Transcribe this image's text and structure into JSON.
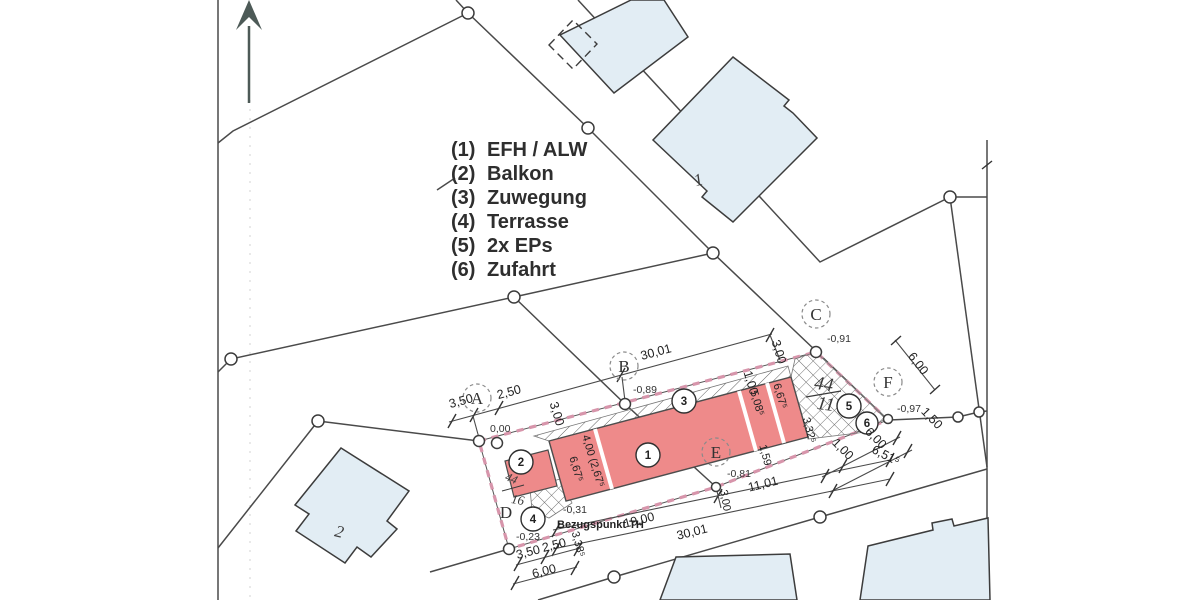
{
  "title": "Lageplan (site plan)",
  "legend": {
    "items": [
      {
        "num": "(1)",
        "label": "EFH / ALW"
      },
      {
        "num": "(2)",
        "label": "Balkon"
      },
      {
        "num": "(3)",
        "label": "Zuwegung"
      },
      {
        "num": "(4)",
        "label": "Terrasse"
      },
      {
        "num": "(5)",
        "label": "2x EPs"
      },
      {
        "num": "(6)",
        "label": "Zufahrt"
      }
    ]
  },
  "badges": {
    "b1": "1",
    "b2": "2",
    "b3": "3",
    "b4": "4",
    "b5": "5",
    "b6": "6"
  },
  "survey_points": {
    "a": {
      "letter": "A",
      "elevation": "0,00"
    },
    "b": {
      "letter": "B",
      "elevation": "-0,89"
    },
    "c": {
      "letter": "C",
      "elevation": "-0,91"
    },
    "d": {
      "letter": "D",
      "elevation": "-0,23"
    },
    "e": {
      "letter": "E",
      "elevation": "-0,81"
    },
    "f": {
      "letter": "F",
      "elevation": "-0,97"
    }
  },
  "reference": {
    "label": "Bezugspunkt TH",
    "elevation": "-0,31"
  },
  "parcels": {
    "north_building": "1",
    "west_building": "2",
    "site_left": {
      "num": "44",
      "den": "16"
    },
    "site_right": {
      "num": "44",
      "den": "11"
    }
  },
  "dimensions": {
    "top": {
      "d1": "3,50",
      "d2": "2,50",
      "d3": "3,00",
      "d4": "30,01",
      "d5": "1,00",
      "d6": "3,00"
    },
    "right": {
      "d1": "6,00",
      "d2": "1,50"
    },
    "building": {
      "d1": "6,67⁵",
      "d2": "4,00 (2,67⁵",
      "d3": "5,08⁵",
      "d4": "6,67⁵",
      "d5": "1,59",
      "d6": "3,32⁵"
    },
    "parking": {
      "d1": "1,00",
      "d2": "6,00",
      "d3": "6,51⁵"
    },
    "bottom": {
      "d1": "19,00",
      "d2": "11,01",
      "d3": "30,01",
      "d4": "3,00",
      "d5": "3,38⁵"
    },
    "bottom_left": {
      "d1": "3,50",
      "d2": "2,50",
      "d3": "6,00"
    }
  },
  "colors": {
    "building_fill": "#ee8a8a",
    "boundary_pink": "#d795ab",
    "parcel_blue": "#e2edf4",
    "line_gray": "#4a4a4a"
  }
}
